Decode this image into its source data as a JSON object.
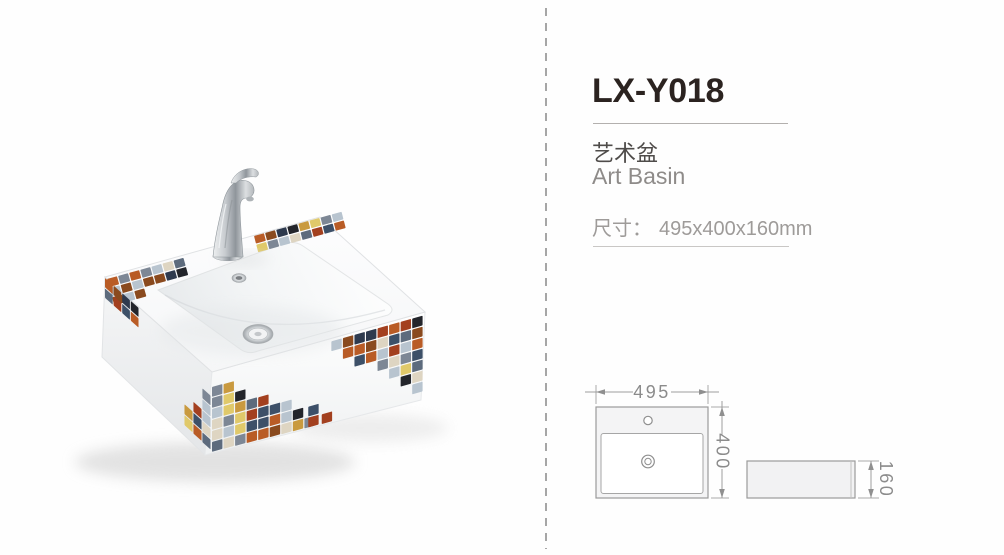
{
  "page": {
    "background": "#fefefe",
    "divider_color": "#a6a6a6"
  },
  "product": {
    "model": "LX-Y018",
    "name_cn": "艺术盆",
    "name_en": "Art Basin",
    "size_label": "尺寸：",
    "size_value": "495x400x160mm"
  },
  "drawing": {
    "top_view": {
      "width": "495",
      "depth": "400"
    },
    "side_view": {
      "height": "160"
    }
  },
  "photo": {
    "ceramic_color": "#ffffff",
    "chrome_color": "#c6cacd",
    "mosaic_palette": [
      "#b95c26",
      "#8a4a1e",
      "#2e3a4e",
      "#23252b",
      "#c99a3f",
      "#e0c96a",
      "#7d8795",
      "#b8c4cf",
      "#ded5c2",
      "#5d6b7d",
      "#a3401f",
      "#3d5068"
    ]
  },
  "text_colors": {
    "model": "#2b2320",
    "name_cn": "#4f4c4a",
    "name_en": "#8e8b89",
    "size": "#9e9b99",
    "drawing": "#8b8b8b"
  }
}
